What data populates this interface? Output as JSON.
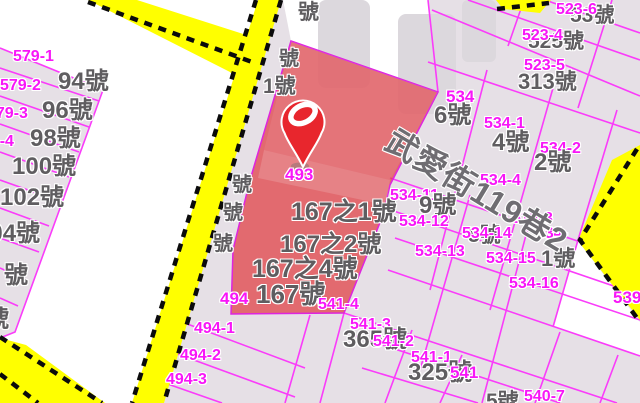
{
  "map": {
    "description": "cadastral parcel map with highlighted parcel and location pin",
    "street_name": "武愛街119巷2",
    "highlighted_house_numbers": [
      "167之1號",
      "167之2號",
      "167之4號",
      "167號"
    ],
    "marker_parcel_id": "493",
    "labels": [
      {
        "kind": "parcel-id",
        "text": "579-1",
        "x": 13,
        "y": 49,
        "size": 16
      },
      {
        "kind": "parcel-id",
        "text": "579-2",
        "x": 0,
        "y": 78,
        "size": 16
      },
      {
        "kind": "parcel-id",
        "text": "579-3",
        "x": -13,
        "y": 106,
        "size": 16
      },
      {
        "kind": "parcel-id",
        "text": "579-4",
        "x": -27,
        "y": 134,
        "size": 16
      },
      {
        "kind": "parcel-id",
        "text": "579-5",
        "x": -42,
        "y": 162,
        "size": 16
      },
      {
        "kind": "house-no",
        "text": "94號",
        "x": 58,
        "y": 70,
        "size": 24
      },
      {
        "kind": "house-no",
        "text": "96號",
        "x": 42,
        "y": 99,
        "size": 24
      },
      {
        "kind": "house-no",
        "text": "98號",
        "x": 30,
        "y": 127,
        "size": 24
      },
      {
        "kind": "house-no",
        "text": "100號",
        "x": 12,
        "y": 155,
        "size": 24
      },
      {
        "kind": "house-no",
        "text": "102號",
        "x": 0,
        "y": 186,
        "size": 24
      },
      {
        "kind": "house-no",
        "text": "104號",
        "x": -24,
        "y": 222,
        "size": 24
      },
      {
        "kind": "fragment",
        "text": "號",
        "x": 4,
        "y": 264,
        "size": 24
      },
      {
        "kind": "fragment",
        "text": "號",
        "x": -15,
        "y": 308,
        "size": 24
      },
      {
        "kind": "fragment",
        "text": "號",
        "x": 298,
        "y": 2,
        "size": 21
      },
      {
        "kind": "fragment",
        "text": "號",
        "x": 279,
        "y": 49,
        "size": 20
      },
      {
        "kind": "fragment",
        "text": "1號",
        "x": 263,
        "y": 76,
        "size": 21
      },
      {
        "kind": "fragment",
        "text": "號",
        "x": 232,
        "y": 175,
        "size": 20
      },
      {
        "kind": "fragment",
        "text": "號",
        "x": 223,
        "y": 203,
        "size": 20
      },
      {
        "kind": "fragment",
        "text": "號",
        "x": 213,
        "y": 234,
        "size": 20
      },
      {
        "kind": "parcel-id",
        "text": "493",
        "x": 285,
        "y": 166,
        "size": 17
      },
      {
        "kind": "house-no",
        "text": "167之1號",
        "x": 291,
        "y": 200,
        "size": 25
      },
      {
        "kind": "house-no",
        "text": "167之2號",
        "x": 280,
        "y": 233,
        "size": 24
      },
      {
        "kind": "house-no",
        "text": "167之4號",
        "x": 252,
        "y": 257,
        "size": 25
      },
      {
        "kind": "house-no",
        "text": "167號",
        "x": 256,
        "y": 281,
        "size": 26
      },
      {
        "kind": "house-no",
        "text": "53號",
        "x": 570,
        "y": 5,
        "size": 21
      },
      {
        "kind": "parcel-id",
        "text": "523-6",
        "x": 556,
        "y": 2,
        "size": 16
      },
      {
        "kind": "house-no",
        "text": "525號",
        "x": 528,
        "y": 31,
        "size": 21
      },
      {
        "kind": "parcel-id",
        "text": "523-4",
        "x": 522,
        "y": 28,
        "size": 16
      },
      {
        "kind": "house-no",
        "text": "313號",
        "x": 518,
        "y": 71,
        "size": 22
      },
      {
        "kind": "parcel-id",
        "text": "523-5",
        "x": 524,
        "y": 58,
        "size": 16
      },
      {
        "kind": "parcel-id",
        "text": "534",
        "x": 446,
        "y": 88,
        "size": 17
      },
      {
        "kind": "house-no",
        "text": "6號",
        "x": 434,
        "y": 104,
        "size": 24
      },
      {
        "kind": "parcel-id",
        "text": "534-1",
        "x": 484,
        "y": 116,
        "size": 16
      },
      {
        "kind": "house-no",
        "text": "4號",
        "x": 492,
        "y": 131,
        "size": 24
      },
      {
        "kind": "parcel-id",
        "text": "534-2",
        "x": 540,
        "y": 141,
        "size": 16
      },
      {
        "kind": "house-no",
        "text": "2號",
        "x": 534,
        "y": 151,
        "size": 24
      },
      {
        "kind": "parcel-id",
        "text": "534-4",
        "x": 480,
        "y": 173,
        "size": 16
      },
      {
        "kind": "parcel-id",
        "text": "534-11",
        "x": 390,
        "y": 188,
        "size": 16
      },
      {
        "kind": "house-no",
        "text": "9號",
        "x": 419,
        "y": 194,
        "size": 24
      },
      {
        "kind": "parcel-id",
        "text": "534-12",
        "x": 399,
        "y": 214,
        "size": 16
      },
      {
        "kind": "parcel-id",
        "text": "534-3",
        "x": 512,
        "y": 211,
        "size": 16
      },
      {
        "kind": "house-no",
        "text": "5號",
        "x": 468,
        "y": 225,
        "size": 21
      },
      {
        "kind": "parcel-id",
        "text": "534-14",
        "x": 462,
        "y": 226,
        "size": 16
      },
      {
        "kind": "parcel-id",
        "text": "534-",
        "x": 536,
        "y": 226,
        "size": 16
      },
      {
        "kind": "parcel-id",
        "text": "534-13",
        "x": 415,
        "y": 244,
        "size": 16
      },
      {
        "kind": "parcel-id",
        "text": "534-15",
        "x": 486,
        "y": 251,
        "size": 16
      },
      {
        "kind": "house-no",
        "text": "1號",
        "x": 541,
        "y": 248,
        "size": 22
      },
      {
        "kind": "parcel-id",
        "text": "534-16",
        "x": 509,
        "y": 276,
        "size": 16
      },
      {
        "kind": "parcel-id",
        "text": "539",
        "x": 613,
        "y": 289,
        "size": 17
      },
      {
        "kind": "parcel-id",
        "text": "494",
        "x": 220,
        "y": 290,
        "size": 17
      },
      {
        "kind": "parcel-id",
        "text": "541-4",
        "x": 318,
        "y": 297,
        "size": 16
      },
      {
        "kind": "parcel-id",
        "text": "494-1",
        "x": 194,
        "y": 321,
        "size": 16
      },
      {
        "kind": "parcel-id",
        "text": "541-3",
        "x": 350,
        "y": 317,
        "size": 16
      },
      {
        "kind": "house-no",
        "text": "365號",
        "x": 343,
        "y": 328,
        "size": 24
      },
      {
        "kind": "parcel-id",
        "text": "541-2",
        "x": 373,
        "y": 334,
        "size": 16
      },
      {
        "kind": "parcel-id",
        "text": "494-2",
        "x": 180,
        "y": 348,
        "size": 16
      },
      {
        "kind": "parcel-id",
        "text": "541-1",
        "x": 411,
        "y": 350,
        "size": 16
      },
      {
        "kind": "house-no",
        "text": "325號",
        "x": 408,
        "y": 361,
        "size": 24
      },
      {
        "kind": "parcel-id",
        "text": "541",
        "x": 450,
        "y": 364,
        "size": 17
      },
      {
        "kind": "parcel-id",
        "text": "494-3",
        "x": 166,
        "y": 372,
        "size": 16
      },
      {
        "kind": "house-no",
        "text": "5號",
        "x": 486,
        "y": 391,
        "size": 21
      },
      {
        "kind": "parcel-id",
        "text": "540-7",
        "x": 524,
        "y": 389,
        "size": 16
      },
      {
        "kind": "street",
        "text": "武愛街119巷2",
        "x": 397,
        "y": 124,
        "size": 32,
        "rotate": 31
      }
    ],
    "colors": {
      "parcel_id": "#f816f8",
      "house_number": "#5f5d60",
      "boundary_line": "#fa3cfa",
      "parcel_fill": "#e6e0e6",
      "road_fill": "#ffff00",
      "highlight_fill": "#e13b41",
      "marker_red": "#e8262d"
    }
  }
}
